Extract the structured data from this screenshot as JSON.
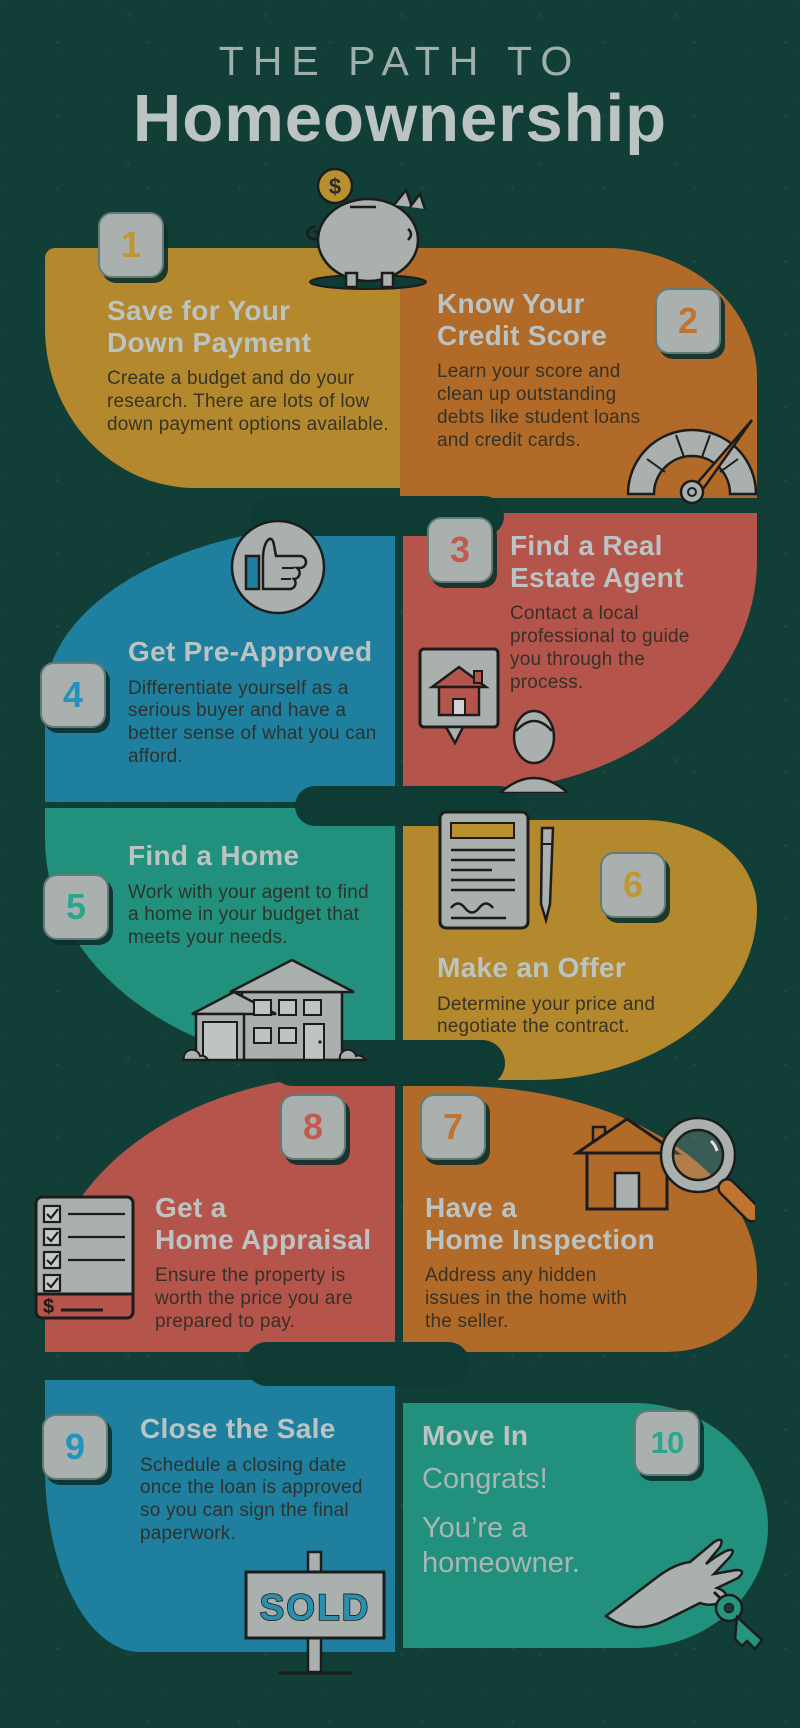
{
  "title": {
    "line1": "THE PATH TO",
    "line2": "Homeownership"
  },
  "palette": {
    "background": "#123E38",
    "connector": "#0F3B35",
    "gold": "#B4882C",
    "orange": "#B16A28",
    "red": "#B5544A",
    "blue": "#1F7F9F",
    "teal": "#21907C",
    "badge_bg": "#A9B0AE",
    "heading": "#BCC4C3",
    "subtitle": "#A9B6B4",
    "body": "#2E2E26"
  },
  "steps": [
    {
      "number": "1",
      "title": "Save for Your\nDown Payment",
      "body": "Create a budget and do your research. There are lots of low down payment options available.",
      "icon": "piggy-bank-icon",
      "accent": "#C0962F"
    },
    {
      "number": "2",
      "title": "Know Your\nCredit Score",
      "body": "Learn your score and clean up outstanding debts like student loans and credit cards.",
      "icon": "credit-gauge-icon",
      "accent": "#C1742F"
    },
    {
      "number": "3",
      "title": "Find a Real\nEstate Agent",
      "body": "Contact a local professional to guide you through the process.",
      "icon": "real-estate-agent-icon",
      "accent": "#C25B4F"
    },
    {
      "number": "4",
      "title": "Get Pre-Approved",
      "body": "Differentiate yourself as a serious buyer and have a better sense of what you can afford.",
      "icon": "thumbs-up-badge-icon",
      "accent": "#2293BC"
    },
    {
      "number": "5",
      "title": "Find a Home",
      "body": "Work with your agent to find a home in your budget that meets your needs.",
      "icon": "house-icon",
      "accent": "#2AA68E"
    },
    {
      "number": "6",
      "title": "Make an Offer",
      "body": "Determine your price and negotiate the contract.",
      "icon": "contract-pen-icon",
      "accent": "#C0962F"
    },
    {
      "number": "7",
      "title": "Have a\nHome Inspection",
      "body": "Address any hidden issues in the home with the seller.",
      "icon": "house-magnifier-icon",
      "accent": "#C1742F"
    },
    {
      "number": "8",
      "title": "Get a\nHome Appraisal",
      "body": "Ensure the property is worth the price you are prepared to pay.",
      "icon": "appraisal-checklist-icon",
      "accent": "#C25B4F"
    },
    {
      "number": "9",
      "title": "Close the Sale",
      "body": "Schedule a closing date once the loan is approved so you can sign the final paperwork.",
      "icon": "sold-sign-icon",
      "accent": "#2293BC"
    },
    {
      "number": "10",
      "title": "Move In",
      "subtitle1": "Congrats!",
      "subtitle2": "You’re a\nhomeowner.",
      "icon": "hand-with-key-icon",
      "accent": "#2AA68E"
    }
  ],
  "sold_sign": {
    "label": "SOLD"
  },
  "symbols": {
    "coin_currency": "$",
    "appraisal_currency": "$"
  }
}
